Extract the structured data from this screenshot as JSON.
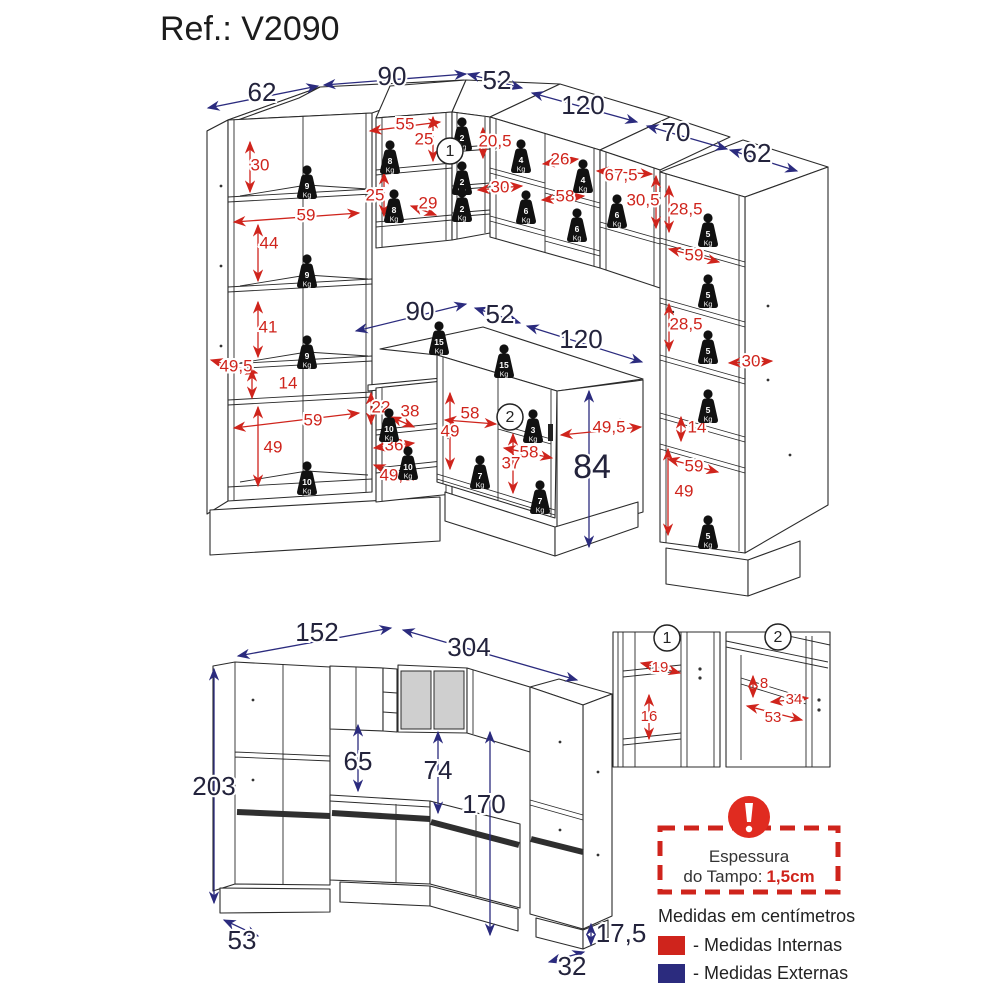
{
  "header": {
    "title": "Ref.: V2090"
  },
  "colors": {
    "internal": "#cf241c",
    "external": "#2b2b7e",
    "external_text": "#23233c",
    "line": "#2b2b2b"
  },
  "weight_unit": "Kg",
  "warning": {
    "line1": "Espessura",
    "line2": "do Tampo:",
    "value": "1,5cm"
  },
  "legend": {
    "units_note": "Medidas em centímetros",
    "internal_label": "- Medidas Internas",
    "external_label": "- Medidas Externas"
  },
  "annotations": {
    "external_dims": [
      {
        "t": "62",
        "x": 262,
        "y": 94,
        "a": [
          208,
          108,
          318,
          86
        ]
      },
      {
        "t": "90",
        "x": 392,
        "y": 78,
        "a": [
          324,
          85,
          466,
          74
        ]
      },
      {
        "t": "52",
        "x": 497,
        "y": 82,
        "a": [
          468,
          74,
          522,
          88
        ]
      },
      {
        "t": "120",
        "x": 583,
        "y": 107,
        "a": [
          532,
          93,
          637,
          122
        ]
      },
      {
        "t": "70",
        "x": 676,
        "y": 134,
        "a": [
          647,
          126,
          727,
          149
        ]
      },
      {
        "t": "62",
        "x": 757,
        "y": 155,
        "a": [
          730,
          150,
          797,
          171
        ]
      },
      {
        "t": "90",
        "x": 420,
        "y": 313,
        "a": [
          356,
          331,
          466,
          304
        ]
      },
      {
        "t": "52",
        "x": 500,
        "y": 316,
        "a": [
          475,
          308,
          520,
          323
        ]
      },
      {
        "t": "120",
        "x": 581,
        "y": 341,
        "a": [
          527,
          326,
          642,
          362
        ]
      },
      {
        "t": "",
        "x": 0,
        "y": 0,
        "a": [
          589,
          391,
          589,
          547
        ]
      },
      {
        "t": "84",
        "x": 592,
        "y": 469,
        "s": 34
      },
      {
        "t": "152",
        "x": 317,
        "y": 634,
        "a": [
          238,
          656,
          391,
          628
        ]
      },
      {
        "t": "304",
        "x": 469,
        "y": 649,
        "a": [
          403,
          630,
          577,
          680
        ]
      },
      {
        "t": "203",
        "x": 214,
        "y": 788,
        "a": [
          214,
          669,
          214,
          903
        ]
      },
      {
        "t": "65",
        "x": 358,
        "y": 763,
        "a": [
          358,
          725,
          358,
          791
        ]
      },
      {
        "t": "74",
        "x": 438,
        "y": 772,
        "a": [
          438,
          732,
          438,
          813
        ]
      },
      {
        "t": "170",
        "x": 484,
        "y": 806,
        "a": [
          490,
          732,
          490,
          935
        ]
      },
      {
        "t": "53",
        "x": 242,
        "y": 942,
        "a": [
          224,
          920,
          258,
          936
        ]
      },
      {
        "t": "17,5",
        "x": 621,
        "y": 935,
        "a": [
          591,
          924,
          591,
          945
        ]
      },
      {
        "t": "32",
        "x": 572,
        "y": 968,
        "a": [
          549,
          962,
          584,
          952
        ]
      }
    ],
    "internal_dims": [
      {
        "t": "30",
        "x": 260,
        "y": 166,
        "a": [
          250,
          142,
          250,
          192
        ]
      },
      {
        "t": "59",
        "x": 306,
        "y": 216,
        "a": [
          234,
          222,
          359,
          213
        ]
      },
      {
        "t": "44",
        "x": 269,
        "y": 244,
        "a": [
          258,
          225,
          258,
          281
        ]
      },
      {
        "t": "41",
        "x": 268,
        "y": 328,
        "a": [
          258,
          302,
          258,
          357
        ]
      },
      {
        "t": "49,5",
        "x": 236,
        "y": 367,
        "a": [
          211,
          360,
          257,
          373
        ]
      },
      {
        "t": "14",
        "x": 288,
        "y": 384,
        "a": [
          252,
          370,
          252,
          398
        ]
      },
      {
        "t": "59",
        "x": 313,
        "y": 421,
        "a": [
          234,
          428,
          359,
          413
        ]
      },
      {
        "t": "49",
        "x": 273,
        "y": 448,
        "a": [
          258,
          407,
          258,
          486
        ]
      },
      {
        "t": "55",
        "x": 405,
        "y": 125,
        "a": [
          370,
          131,
          440,
          122
        ]
      },
      {
        "t": "25",
        "x": 424,
        "y": 140,
        "a": [
          433,
          117,
          433,
          161
        ]
      },
      {
        "t": "25",
        "x": 375,
        "y": 196,
        "a": [
          384,
          173,
          384,
          216
        ]
      },
      {
        "t": "29",
        "x": 428,
        "y": 204,
        "a": [
          411,
          206,
          436,
          215
        ]
      },
      {
        "t": "20,5",
        "x": 495,
        "y": 142,
        "a": [
          483,
          128,
          483,
          158
        ]
      },
      {
        "t": "26",
        "x": 560,
        "y": 160,
        "a": [
          543,
          164,
          578,
          159
        ]
      },
      {
        "t": "30",
        "x": 500,
        "y": 188,
        "a": [
          478,
          190,
          522,
          186
        ]
      },
      {
        "t": "58",
        "x": 565,
        "y": 197,
        "a": [
          542,
          200,
          584,
          196
        ]
      },
      {
        "t": "67,5",
        "x": 621,
        "y": 176,
        "a": [
          597,
          171,
          652,
          174
        ]
      },
      {
        "t": "30,5",
        "x": 643,
        "y": 201,
        "a": [
          656,
          176,
          656,
          228
        ]
      },
      {
        "t": "28,5",
        "x": 686,
        "y": 210,
        "a": [
          669,
          186,
          669,
          232
        ]
      },
      {
        "t": "59",
        "x": 694,
        "y": 256,
        "a": [
          669,
          249,
          719,
          262
        ]
      },
      {
        "t": "28,5",
        "x": 686,
        "y": 325,
        "a": [
          669,
          304,
          669,
          351
        ]
      },
      {
        "t": "30",
        "x": 751,
        "y": 362,
        "a": [
          729,
          363,
          772,
          361
        ]
      },
      {
        "t": "14",
        "x": 697,
        "y": 428,
        "a": [
          681,
          417,
          681,
          441
        ]
      },
      {
        "t": "59",
        "x": 694,
        "y": 467,
        "a": [
          668,
          459,
          718,
          472
        ]
      },
      {
        "t": "49",
        "x": 684,
        "y": 492,
        "a": [
          668,
          449,
          668,
          535
        ]
      },
      {
        "t": "22",
        "x": 381,
        "y": 408,
        "a": [
          371,
          393,
          371,
          424
        ]
      },
      {
        "t": "38",
        "x": 410,
        "y": 412,
        "a": [
          391,
          417,
          414,
          427
        ]
      },
      {
        "t": "36",
        "x": 394,
        "y": 446,
        "a": [
          374,
          448,
          414,
          443
        ]
      },
      {
        "t": "49,5",
        "x": 396,
        "y": 476,
        "a": [
          374,
          465,
          413,
          480
        ]
      },
      {
        "t": "58",
        "x": 470,
        "y": 414,
        "a": [
          445,
          420,
          496,
          424
        ]
      },
      {
        "t": "49",
        "x": 450,
        "y": 432,
        "a": [
          450,
          393,
          450,
          469
        ]
      },
      {
        "t": "49,5",
        "x": 609,
        "y": 428,
        "a": [
          561,
          435,
          641,
          427
        ]
      },
      {
        "t": "58",
        "x": 529,
        "y": 453,
        "a": [
          504,
          448,
          552,
          458
        ]
      },
      {
        "t": "37",
        "x": 511,
        "y": 464,
        "a": [
          513,
          434,
          513,
          493
        ]
      },
      {
        "t": "19",
        "x": 660,
        "y": 668,
        "s": 15,
        "a": [
          641,
          663,
          680,
          673
        ]
      },
      {
        "t": "16",
        "x": 649,
        "y": 717,
        "s": 15,
        "a": [
          649,
          695,
          649,
          739
        ]
      },
      {
        "t": "8",
        "x": 764,
        "y": 684,
        "s": 15,
        "a": [
          753,
          676,
          753,
          697
        ]
      },
      {
        "t": "34",
        "x": 794,
        "y": 700,
        "s": 15,
        "a": [
          771,
          702,
          808,
          698
        ]
      },
      {
        "t": "53",
        "x": 773,
        "y": 718,
        "s": 15,
        "a": [
          747,
          706,
          802,
          720
        ]
      }
    ],
    "weights": [
      {
        "kg": "9",
        "x": 307,
        "y": 170
      },
      {
        "kg": "9",
        "x": 307,
        "y": 259
      },
      {
        "kg": "9",
        "x": 307,
        "y": 340
      },
      {
        "kg": "10",
        "x": 307,
        "y": 466
      },
      {
        "kg": "8",
        "x": 390,
        "y": 145
      },
      {
        "kg": "8",
        "x": 394,
        "y": 194
      },
      {
        "kg": "2",
        "x": 462,
        "y": 122
      },
      {
        "kg": "2",
        "x": 462,
        "y": 166
      },
      {
        "kg": "2",
        "x": 462,
        "y": 193
      },
      {
        "kg": "4",
        "x": 521,
        "y": 144
      },
      {
        "kg": "4",
        "x": 583,
        "y": 164
      },
      {
        "kg": "6",
        "x": 526,
        "y": 195
      },
      {
        "kg": "6",
        "x": 577,
        "y": 213
      },
      {
        "kg": "6",
        "x": 617,
        "y": 199
      },
      {
        "kg": "5",
        "x": 708,
        "y": 218
      },
      {
        "kg": "5",
        "x": 708,
        "y": 279
      },
      {
        "kg": "5",
        "x": 708,
        "y": 335
      },
      {
        "kg": "5",
        "x": 708,
        "y": 394
      },
      {
        "kg": "5",
        "x": 708,
        "y": 520
      },
      {
        "kg": "10",
        "x": 389,
        "y": 413
      },
      {
        "kg": "10",
        "x": 408,
        "y": 451
      },
      {
        "kg": "15",
        "x": 439,
        "y": 326
      },
      {
        "kg": "15",
        "x": 504,
        "y": 349
      },
      {
        "kg": "3",
        "x": 533,
        "y": 414
      },
      {
        "kg": "7",
        "x": 480,
        "y": 460
      },
      {
        "kg": "7",
        "x": 540,
        "y": 485
      }
    ],
    "circled_refs": [
      {
        "n": "1",
        "x": 450,
        "y": 151
      },
      {
        "n": "2",
        "x": 510,
        "y": 417
      },
      {
        "n": "1",
        "x": 667,
        "y": 638
      },
      {
        "n": "2",
        "x": 778,
        "y": 637
      }
    ]
  }
}
